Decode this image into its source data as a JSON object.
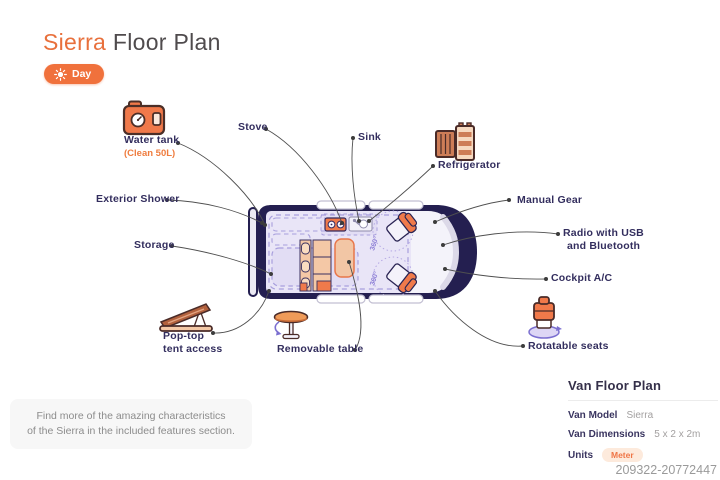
{
  "title": {
    "brand": "Sierra",
    "rest": " Floor Plan"
  },
  "toggle": {
    "label": "Day"
  },
  "labels": {
    "water_tank": "Water tank",
    "water_tank_sub": "(Clean 50L)",
    "stove": "Stove",
    "sink": "Sink",
    "refrigerator": "Refrigerator",
    "manual_gear": "Manual Gear",
    "radio_line1": "Radio with USB",
    "radio_line2": "and Bluetooth",
    "cockpit_ac": "Cockpit A/C",
    "exterior_shower": "Exterior Shower",
    "storage": "Storage",
    "pop_top_line1": "Pop-top",
    "pop_top_line2": "tent access",
    "removable_table": "Removable table",
    "rotatable_seats": "Rotatable seats"
  },
  "van": {
    "seat_rotation_label": "360°"
  },
  "note": {
    "line1": "Find more of the amazing characteristics",
    "line2": "of the Sierra in the included features section."
  },
  "details_panel": {
    "heading": "Van Floor Plan",
    "rows": [
      {
        "label": "Van Model",
        "value": "Sierra"
      },
      {
        "label": "Van Dimensions",
        "value": "5 x 2 x 2m"
      },
      {
        "label": "Units",
        "value": "Meter"
      }
    ]
  },
  "watermark": "209322-20772447",
  "colors": {
    "accent_orange": "#f0713c",
    "body_navy": "#241f50",
    "label_navy": "#332e5e",
    "interior_lavender": "#e9e5f7",
    "dashed_purple": "#a89fdd",
    "peach": "#f4c8a6"
  }
}
